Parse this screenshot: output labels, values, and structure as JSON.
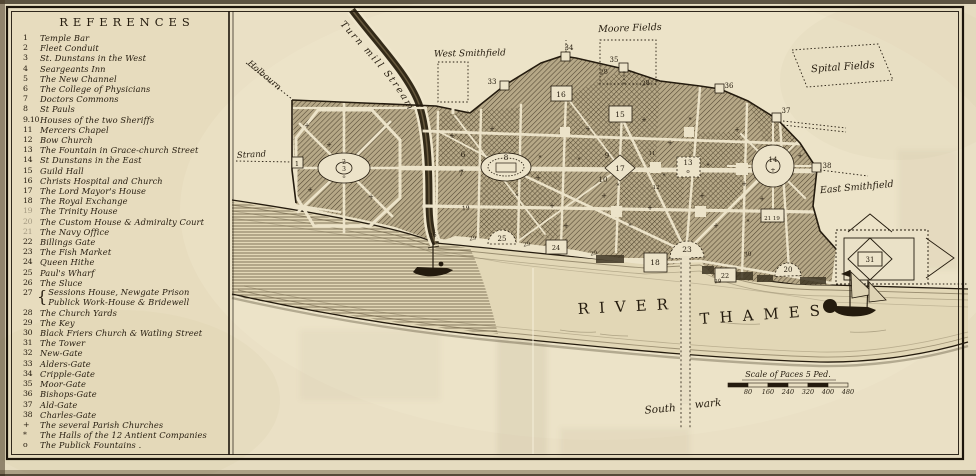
{
  "references_title": "REFERENCES",
  "references": [
    {
      "num": "1",
      "label": "Temple Bar"
    },
    {
      "num": "2",
      "label": "Fleet Conduit"
    },
    {
      "num": "3",
      "label": "St. Dunstans in the West"
    },
    {
      "num": "4",
      "label": "Seargeants Inn"
    },
    {
      "num": "5",
      "label": "The New Channel"
    },
    {
      "num": "6",
      "label": "The College of Physicians"
    },
    {
      "num": "7",
      "label": "Doctors Commons"
    },
    {
      "num": "8",
      "label": "St Pauls"
    },
    {
      "num": "9.10",
      "label": "Houses of the two Sheriffs"
    },
    {
      "num": "11",
      "label": "Mercers Chapel"
    },
    {
      "num": "12",
      "label": "Bow Church"
    },
    {
      "num": "13",
      "label": "The Fountain in Grace-church Street"
    },
    {
      "num": "14",
      "label": "St Dunstans in the East"
    },
    {
      "num": "15",
      "label": "Guild Hall"
    },
    {
      "num": "16",
      "label": "Christs Hospital and Church"
    },
    {
      "num": "17",
      "label": "The Lord Mayor's House"
    },
    {
      "num": "18",
      "label": "The Royal Exchange"
    },
    {
      "num": "19",
      "label": "The Trinity House",
      "faded": true
    },
    {
      "num": "20",
      "label": "The Custom House & Admiralty Court",
      "faded": true
    },
    {
      "num": "21",
      "label": "The Navy Office",
      "faded": true
    },
    {
      "num": "22",
      "label": "Billings Gate"
    },
    {
      "num": "23",
      "label": "The Fish Market"
    },
    {
      "num": "24",
      "label": "Queen Hithe"
    },
    {
      "num": "25",
      "label": "Paul's Wharf"
    },
    {
      "num": "26",
      "label": "The Sluce"
    },
    {
      "num": "27",
      "label": "Sessions House, Newgate Prison\nPublick Work-House & Bridewell",
      "two": true
    },
    {
      "num": "28",
      "label": "The Church Yards"
    },
    {
      "num": "29",
      "label": "The Key"
    },
    {
      "num": "30",
      "label": "Black Friers Church & Watling Street"
    },
    {
      "num": "31",
      "label": "The Tower"
    },
    {
      "num": "32",
      "label": "New-Gate"
    },
    {
      "num": "33",
      "label": "Alders-Gate"
    },
    {
      "num": "34",
      "label": "Cripple-Gate"
    },
    {
      "num": "35",
      "label": "Moor-Gate"
    },
    {
      "num": "36",
      "label": "Bishops-Gate"
    },
    {
      "num": "37",
      "label": "Ald-Gate"
    },
    {
      "num": "38",
      "label": "Charles-Gate"
    },
    {
      "num": "+",
      "label": "The several Parish Churches"
    },
    {
      "num": "*",
      "label": "The Halls of the 12 Antient Companies"
    },
    {
      "num": "o",
      "label": "The Publick Fountains ."
    }
  ],
  "map": {
    "region_labels": [
      {
        "text": "Turn mill Stream",
        "path": "stream-label-path",
        "fs": 9.5,
        "ls": 1.8
      },
      {
        "text": "Holbourn",
        "x": 247,
        "y": 64,
        "fs": 8.5,
        "rot": 40
      },
      {
        "text": "Strand",
        "x": 237,
        "y": 158,
        "fs": 8.5,
        "rot": -3
      },
      {
        "text": "West Smithfield",
        "x": 470,
        "y": 56,
        "fs": 9,
        "rot": -1,
        "anchor": "middle"
      },
      {
        "text": "Moore Fields",
        "x": 630,
        "y": 31,
        "fs": 9.5,
        "rot": -2,
        "anchor": "middle"
      },
      {
        "text": "Spital Fields",
        "x": 843,
        "y": 70,
        "fs": 10,
        "rot": -4,
        "anchor": "middle"
      },
      {
        "text": "East Smithfield",
        "x": 857,
        "y": 190,
        "fs": 9.5,
        "rot": -5,
        "anchor": "middle"
      },
      {
        "text": "RIVER",
        "x": 578,
        "y": 314,
        "fs": 15,
        "ls": 11,
        "rot": -3,
        "cls": "river-name"
      },
      {
        "text": "THAMES",
        "x": 700,
        "y": 324,
        "fs": 15,
        "ls": 10,
        "rot": -4,
        "cls": "river-name"
      },
      {
        "text": "South",
        "x": 676,
        "y": 411,
        "fs": 10.5,
        "rot": -5,
        "anchor": "end"
      },
      {
        "text": "wark",
        "x": 695,
        "y": 408,
        "fs": 10.5,
        "rot": -5
      }
    ],
    "markers": [
      {
        "n": "1",
        "x": 297,
        "y": 166,
        "fs": 6.5
      },
      {
        "n": "2",
        "x": 344,
        "y": 164,
        "fs": 6
      },
      {
        "n": "3",
        "x": 344,
        "y": 171,
        "fs": 6
      },
      {
        "n": "o",
        "x": 344,
        "y": 178,
        "fs": 5
      },
      {
        "n": "6",
        "x": 463,
        "y": 157,
        "fs": 7.5
      },
      {
        "n": "7",
        "x": 461,
        "y": 176,
        "fs": 7.5
      },
      {
        "n": "8",
        "x": 506,
        "y": 160,
        "fs": 7.5
      },
      {
        "n": "9",
        "x": 607,
        "y": 158,
        "fs": 7
      },
      {
        "n": "10",
        "x": 603,
        "y": 182,
        "fs": 7
      },
      {
        "n": "11",
        "x": 652,
        "y": 155,
        "fs": 5.5
      },
      {
        "n": "12",
        "x": 656,
        "y": 189,
        "fs": 5.5
      },
      {
        "n": "13",
        "x": 688,
        "y": 165,
        "fs": 7
      },
      {
        "n": "o",
        "x": 688,
        "y": 173,
        "fs": 5.5
      },
      {
        "n": "14",
        "x": 773,
        "y": 162,
        "fs": 7
      },
      {
        "n": "+",
        "x": 773,
        "y": 172,
        "fs": 6.5
      },
      {
        "n": "15",
        "x": 620,
        "y": 117,
        "fs": 7.5
      },
      {
        "n": "16",
        "x": 561,
        "y": 97,
        "fs": 7.5
      },
      {
        "n": "17",
        "x": 620,
        "y": 171,
        "fs": 7.5
      },
      {
        "n": "18",
        "x": 655,
        "y": 265,
        "fs": 7.5
      },
      {
        "n": "19",
        "x": 466,
        "y": 210,
        "fs": 6,
        "rot": -6
      },
      {
        "n": "20",
        "x": 788,
        "y": 272,
        "fs": 7
      },
      {
        "n": "21 19",
        "x": 772,
        "y": 220,
        "fs": 5.5
      },
      {
        "n": "22",
        "x": 725,
        "y": 278,
        "fs": 6.5
      },
      {
        "n": "23",
        "x": 687,
        "y": 252,
        "fs": 7.5
      },
      {
        "n": "24",
        "x": 556,
        "y": 250,
        "fs": 6.5
      },
      {
        "n": "25",
        "x": 502,
        "y": 241,
        "fs": 7
      },
      {
        "n": "26",
        "x": 433,
        "y": 237,
        "fs": 6,
        "rot": -8
      },
      {
        "n": "28",
        "x": 604,
        "y": 74,
        "fs": 6.5,
        "rot": -8
      },
      {
        "n": "28",
        "x": 646,
        "y": 85,
        "fs": 6.5,
        "rot": -8
      },
      {
        "n": "29",
        "x": 473,
        "y": 240,
        "fs": 5.5,
        "rot": -8
      },
      {
        "n": "29",
        "x": 527,
        "y": 246,
        "fs": 5.5,
        "rot": -8
      },
      {
        "n": "29",
        "x": 594,
        "y": 255,
        "fs": 5.5,
        "rot": -10
      },
      {
        "n": "29",
        "x": 718,
        "y": 283,
        "fs": 5.5,
        "rot": -4
      },
      {
        "n": "30",
        "x": 748,
        "y": 256,
        "fs": 6,
        "rot": -8
      },
      {
        "n": "31",
        "x": 870,
        "y": 262,
        "fs": 7
      },
      {
        "n": "33",
        "x": 492,
        "y": 84,
        "fs": 7
      },
      {
        "n": "34",
        "x": 569,
        "y": 50,
        "fs": 7
      },
      {
        "n": "35",
        "x": 614,
        "y": 62,
        "fs": 7
      },
      {
        "n": "36",
        "x": 729,
        "y": 88,
        "fs": 7
      },
      {
        "n": "37",
        "x": 786,
        "y": 113,
        "fs": 7
      },
      {
        "n": "38",
        "x": 827,
        "y": 168,
        "fs": 7
      },
      {
        "n": "+",
        "x": 307,
        "y": 128,
        "fs": 7
      },
      {
        "n": "+",
        "x": 329,
        "y": 147,
        "fs": 7
      },
      {
        "n": "+",
        "x": 310,
        "y": 192,
        "fs": 7
      },
      {
        "n": "+",
        "x": 371,
        "y": 199,
        "fs": 7
      },
      {
        "n": "+",
        "x": 452,
        "y": 138,
        "fs": 7
      },
      {
        "n": "+",
        "x": 492,
        "y": 131,
        "fs": 7
      },
      {
        "n": "+",
        "x": 538,
        "y": 180,
        "fs": 7
      },
      {
        "n": "+",
        "x": 552,
        "y": 208,
        "fs": 7
      },
      {
        "n": "+",
        "x": 588,
        "y": 131,
        "fs": 7
      },
      {
        "n": "+",
        "x": 604,
        "y": 198,
        "fs": 7
      },
      {
        "n": "+",
        "x": 644,
        "y": 122,
        "fs": 7
      },
      {
        "n": "+",
        "x": 670,
        "y": 145,
        "fs": 7
      },
      {
        "n": "+",
        "x": 702,
        "y": 198,
        "fs": 7
      },
      {
        "n": "+",
        "x": 737,
        "y": 132,
        "fs": 7
      },
      {
        "n": "+",
        "x": 762,
        "y": 201,
        "fs": 7
      },
      {
        "n": "+",
        "x": 650,
        "y": 210,
        "fs": 7
      },
      {
        "n": "+",
        "x": 716,
        "y": 228,
        "fs": 7
      },
      {
        "n": "+",
        "x": 566,
        "y": 228,
        "fs": 7
      },
      {
        "n": "+",
        "x": 800,
        "y": 158,
        "fs": 7
      },
      {
        "n": "+",
        "x": 744,
        "y": 186,
        "fs": 7
      },
      {
        "n": "*",
        "x": 462,
        "y": 174,
        "fs": 6
      },
      {
        "n": "*",
        "x": 517,
        "y": 198,
        "fs": 6
      },
      {
        "n": "*",
        "x": 579,
        "y": 162,
        "fs": 6
      },
      {
        "n": "*",
        "x": 618,
        "y": 188,
        "fs": 6
      },
      {
        "n": "*",
        "x": 664,
        "y": 178,
        "fs": 6
      },
      {
        "n": "*",
        "x": 708,
        "y": 168,
        "fs": 6
      },
      {
        "n": "*",
        "x": 748,
        "y": 224,
        "fs": 6
      },
      {
        "n": "*",
        "x": 690,
        "y": 122,
        "fs": 6
      },
      {
        "n": "*",
        "x": 630,
        "y": 228,
        "fs": 6
      },
      {
        "n": "*",
        "x": 540,
        "y": 160,
        "fs": 6
      }
    ],
    "scale": {
      "title": "Scale of Paces 5 Ped.",
      "ticks": [
        "80",
        "160",
        "240",
        "320",
        "400",
        "480"
      ]
    }
  },
  "colors": {
    "paper": "#e8dec2",
    "ink": "#241b0e",
    "block_hatch": "#b6a887",
    "water_shade": "#5d5036"
  }
}
